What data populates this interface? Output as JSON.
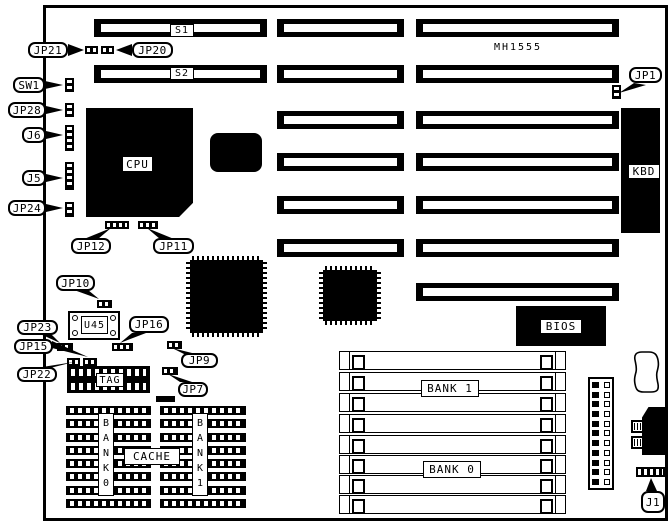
{
  "colors": {
    "ink": "#000000",
    "paper": "#ffffff"
  },
  "board": {
    "model": "MH1555",
    "expansion_slot_rows": 7,
    "simm_sockets_per_bank": 4,
    "cache_rows_per_block": 8
  },
  "slots": {
    "s1": "S1",
    "s2": "S2"
  },
  "chips": {
    "cpu": "CPU",
    "kbd": "KBD",
    "bios": "BIOS",
    "tag": "TAG",
    "cache": "CACHE",
    "u45": "U45"
  },
  "memory": {
    "simm_bank1": "BANK 1",
    "simm_bank0": "BANK 0",
    "cache_bank0_vertical": "B A N K 0",
    "cache_bank1_vertical": "B A N K 1"
  },
  "connectors": {
    "jp21": "JP21",
    "jp20": "JP20",
    "sw1": "SW1",
    "jp28": "JP28",
    "j6": "J6",
    "j5": "J5",
    "jp24": "JP24",
    "jp12": "JP12",
    "jp11": "JP11",
    "jp1": "JP1",
    "jp10": "JP10",
    "jp23": "JP23",
    "jp15": "JP15",
    "jp22": "JP22",
    "jp16": "JP16",
    "jp9": "JP9",
    "jp7": "JP7",
    "j1": "J1"
  }
}
